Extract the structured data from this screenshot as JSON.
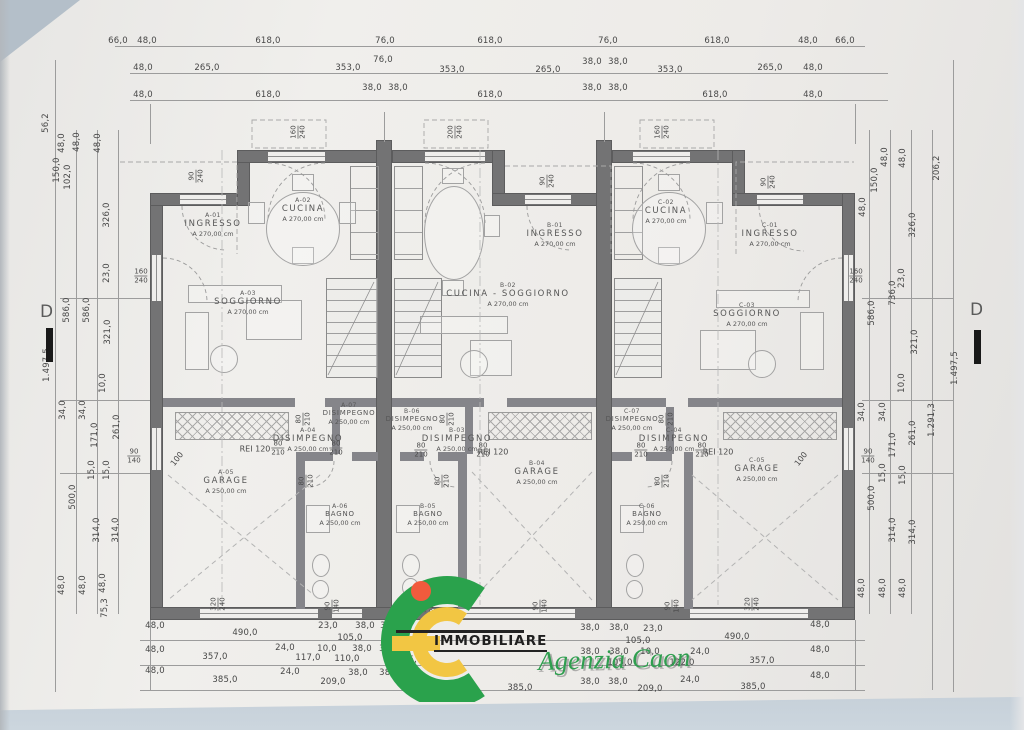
{
  "logo": {
    "brand": "IMMOBILIARE",
    "agency": "Agenzia Caon",
    "green": "#2aa24c",
    "yellow": "#f2c643",
    "red": "#f15b3d"
  },
  "section_markers": {
    "left": "D",
    "right": "D"
  },
  "dims_top": [
    {
      "t": "66,0",
      "x": 118,
      "y": 41
    },
    {
      "t": "48,0",
      "x": 147,
      "y": 41
    },
    {
      "t": "618,0",
      "x": 268,
      "y": 41
    },
    {
      "t": "76,0",
      "x": 385,
      "y": 41
    },
    {
      "t": "618,0",
      "x": 490,
      "y": 41
    },
    {
      "t": "76,0",
      "x": 608,
      "y": 41
    },
    {
      "t": "618,0",
      "x": 717,
      "y": 41
    },
    {
      "t": "48,0",
      "x": 808,
      "y": 41
    },
    {
      "t": "66,0",
      "x": 845,
      "y": 41
    },
    {
      "t": "48,0",
      "x": 143,
      "y": 68
    },
    {
      "t": "265,0",
      "x": 207,
      "y": 68
    },
    {
      "t": "353,0",
      "x": 348,
      "y": 68
    },
    {
      "t": "76,0",
      "x": 383,
      "y": 60
    },
    {
      "t": "353,0",
      "x": 452,
      "y": 70
    },
    {
      "t": "265,0",
      "x": 548,
      "y": 70
    },
    {
      "t": "38,0",
      "x": 592,
      "y": 62
    },
    {
      "t": "38,0",
      "x": 618,
      "y": 62
    },
    {
      "t": "353,0",
      "x": 670,
      "y": 70
    },
    {
      "t": "265,0",
      "x": 770,
      "y": 68
    },
    {
      "t": "48,0",
      "x": 813,
      "y": 68
    },
    {
      "t": "48,0",
      "x": 143,
      "y": 95
    },
    {
      "t": "618,0",
      "x": 268,
      "y": 95
    },
    {
      "t": "38,0",
      "x": 372,
      "y": 88
    },
    {
      "t": "38,0",
      "x": 398,
      "y": 88
    },
    {
      "t": "618,0",
      "x": 490,
      "y": 95
    },
    {
      "t": "38,0",
      "x": 592,
      "y": 88
    },
    {
      "t": "38,0",
      "x": 618,
      "y": 88
    },
    {
      "t": "618,0",
      "x": 715,
      "y": 95
    },
    {
      "t": "48,0",
      "x": 813,
      "y": 95
    }
  ],
  "dims_bottom": [
    {
      "t": "48,0",
      "x": 155,
      "y": 626
    },
    {
      "t": "490,0",
      "x": 245,
      "y": 633
    },
    {
      "t": "23,0",
      "x": 328,
      "y": 626
    },
    {
      "t": "105,0",
      "x": 350,
      "y": 638
    },
    {
      "t": "38,0",
      "x": 365,
      "y": 626
    },
    {
      "t": "38,0",
      "x": 390,
      "y": 626
    },
    {
      "t": "38,0",
      "x": 590,
      "y": 628
    },
    {
      "t": "38,0",
      "x": 619,
      "y": 628
    },
    {
      "t": "23,0",
      "x": 653,
      "y": 629
    },
    {
      "t": "105,0",
      "x": 638,
      "y": 641
    },
    {
      "t": "490,0",
      "x": 737,
      "y": 637
    },
    {
      "t": "48,0",
      "x": 820,
      "y": 625
    },
    {
      "t": "48,0",
      "x": 155,
      "y": 650
    },
    {
      "t": "357,0",
      "x": 215,
      "y": 657
    },
    {
      "t": "24,0",
      "x": 285,
      "y": 648
    },
    {
      "t": "117,0",
      "x": 308,
      "y": 658
    },
    {
      "t": "10,0",
      "x": 327,
      "y": 649
    },
    {
      "t": "110,0",
      "x": 347,
      "y": 659
    },
    {
      "t": "38,0",
      "x": 362,
      "y": 649
    },
    {
      "t": "38,0",
      "x": 389,
      "y": 649
    },
    {
      "t": "105,0",
      "x": 410,
      "y": 660
    },
    {
      "t": "38,0",
      "x": 590,
      "y": 652
    },
    {
      "t": "38,0",
      "x": 619,
      "y": 652
    },
    {
      "t": "10,0",
      "x": 650,
      "y": 652
    },
    {
      "t": "105,0",
      "x": 620,
      "y": 663
    },
    {
      "t": "122,0",
      "x": 682,
      "y": 663
    },
    {
      "t": "24,0",
      "x": 700,
      "y": 652
    },
    {
      "t": "357,0",
      "x": 762,
      "y": 661
    },
    {
      "t": "48,0",
      "x": 820,
      "y": 650
    },
    {
      "t": "48,0",
      "x": 155,
      "y": 671
    },
    {
      "t": "385,0",
      "x": 225,
      "y": 680
    },
    {
      "t": "24,0",
      "x": 290,
      "y": 672
    },
    {
      "t": "209,0",
      "x": 333,
      "y": 682
    },
    {
      "t": "38,0",
      "x": 358,
      "y": 673
    },
    {
      "t": "38,0",
      "x": 389,
      "y": 673
    },
    {
      "t": "385,0",
      "x": 520,
      "y": 688
    },
    {
      "t": "38,0",
      "x": 590,
      "y": 682
    },
    {
      "t": "38,0",
      "x": 618,
      "y": 682
    },
    {
      "t": "209,0",
      "x": 650,
      "y": 689
    },
    {
      "t": "24,0",
      "x": 690,
      "y": 680
    },
    {
      "t": "385,0",
      "x": 753,
      "y": 687
    },
    {
      "t": "48,0",
      "x": 820,
      "y": 676
    }
  ],
  "dims_left": [
    {
      "t": "56,2",
      "x": 46,
      "y": 123,
      "rot": 1
    },
    {
      "t": "48,0",
      "x": 62,
      "y": 143,
      "rot": 1
    },
    {
      "t": "150,0",
      "x": 57,
      "y": 170,
      "rot": 1
    },
    {
      "t": "102,0",
      "x": 68,
      "y": 177,
      "rot": 1
    },
    {
      "t": "48,0",
      "x": 77,
      "y": 142,
      "rot": 1
    },
    {
      "t": "48,0",
      "x": 98,
      "y": 143,
      "rot": 1
    },
    {
      "t": "326,0",
      "x": 107,
      "y": 215,
      "rot": 1
    },
    {
      "t": "23,0",
      "x": 107,
      "y": 273,
      "rot": 1
    },
    {
      "t": "586,0",
      "x": 67,
      "y": 310,
      "rot": 1
    },
    {
      "t": "586,0",
      "x": 87,
      "y": 310,
      "rot": 1
    },
    {
      "t": "321,0",
      "x": 108,
      "y": 332,
      "rot": 1
    },
    {
      "t": "1.497,5",
      "x": 47,
      "y": 365,
      "rot": 1
    },
    {
      "t": "10,0",
      "x": 103,
      "y": 383,
      "rot": 1
    },
    {
      "t": "34,0",
      "x": 63,
      "y": 410,
      "rot": 1
    },
    {
      "t": "34,0",
      "x": 83,
      "y": 410,
      "rot": 1
    },
    {
      "t": "171,0",
      "x": 95,
      "y": 435,
      "rot": 1
    },
    {
      "t": "261,0",
      "x": 117,
      "y": 427,
      "rot": 1
    },
    {
      "t": "15,0",
      "x": 92,
      "y": 470,
      "rot": 1
    },
    {
      "t": "15,0",
      "x": 107,
      "y": 470,
      "rot": 1
    },
    {
      "t": "500,0",
      "x": 73,
      "y": 497,
      "rot": 1
    },
    {
      "t": "314,0",
      "x": 97,
      "y": 530,
      "rot": 1
    },
    {
      "t": "314,0",
      "x": 116,
      "y": 530,
      "rot": 1
    },
    {
      "t": "48,0",
      "x": 62,
      "y": 585,
      "rot": 1
    },
    {
      "t": "48,0",
      "x": 83,
      "y": 585,
      "rot": 1
    },
    {
      "t": "48,0",
      "x": 103,
      "y": 583,
      "rot": 1
    },
    {
      "t": "75,3",
      "x": 105,
      "y": 608,
      "rot": 1
    }
  ],
  "dims_right": [
    {
      "t": "206,2",
      "x": 937,
      "y": 168,
      "rot": 1
    },
    {
      "t": "150,0",
      "x": 875,
      "y": 180,
      "rot": 1
    },
    {
      "t": "48,0",
      "x": 885,
      "y": 157,
      "rot": 1
    },
    {
      "t": "48,0",
      "x": 903,
      "y": 158,
      "rot": 1
    },
    {
      "t": "48,0",
      "x": 863,
      "y": 207,
      "rot": 1
    },
    {
      "t": "326,0",
      "x": 913,
      "y": 225,
      "rot": 1
    },
    {
      "t": "736,0",
      "x": 893,
      "y": 293,
      "rot": 1
    },
    {
      "t": "23,0",
      "x": 902,
      "y": 278,
      "rot": 1
    },
    {
      "t": "586,0",
      "x": 872,
      "y": 313,
      "rot": 1
    },
    {
      "t": "321,0",
      "x": 915,
      "y": 342,
      "rot": 1
    },
    {
      "t": "1.497,5",
      "x": 955,
      "y": 368,
      "rot": 1
    },
    {
      "t": "10,0",
      "x": 902,
      "y": 383,
      "rot": 1
    },
    {
      "t": "1.291,3",
      "x": 932,
      "y": 420,
      "rot": 1
    },
    {
      "t": "34,0",
      "x": 862,
      "y": 412,
      "rot": 1
    },
    {
      "t": "34,0",
      "x": 883,
      "y": 412,
      "rot": 1
    },
    {
      "t": "171,0",
      "x": 893,
      "y": 445,
      "rot": 1
    },
    {
      "t": "261,0",
      "x": 913,
      "y": 433,
      "rot": 1
    },
    {
      "t": "15,0",
      "x": 883,
      "y": 473,
      "rot": 1
    },
    {
      "t": "15,0",
      "x": 903,
      "y": 475,
      "rot": 1
    },
    {
      "t": "500,0",
      "x": 872,
      "y": 498,
      "rot": 1
    },
    {
      "t": "314,0",
      "x": 893,
      "y": 530,
      "rot": 1
    },
    {
      "t": "314,0",
      "x": 913,
      "y": 532,
      "rot": 1
    },
    {
      "t": "48,0",
      "x": 862,
      "y": 588,
      "rot": 1
    },
    {
      "t": "48,0",
      "x": 883,
      "y": 588,
      "rot": 1
    },
    {
      "t": "48,0",
      "x": 903,
      "y": 588,
      "rot": 1
    }
  ],
  "rooms": [
    {
      "c": "A-01",
      "n": "INGRESSO",
      "a": "A 270,00 cm",
      "x": 213,
      "y": 225
    },
    {
      "c": "A-02",
      "n": "CUCINA",
      "a": "A 270,00 cm",
      "x": 303,
      "y": 210
    },
    {
      "c": "A-03",
      "n": "SOGGIORNO",
      "a": "A 270,00 cm",
      "x": 248,
      "y": 303
    },
    {
      "c": "A-07",
      "n": "DISIMPEGNO",
      "a": "A 250,00 cm",
      "x": 349,
      "y": 414,
      "s": 1
    },
    {
      "c": "A-04",
      "n": "DISIMPEGNO",
      "a": "A 250,00 cm",
      "x": 308,
      "y": 440
    },
    {
      "c": "A-05",
      "n": "GARAGE",
      "a": "A 250,00 cm",
      "x": 226,
      "y": 482
    },
    {
      "c": "A-06",
      "n": "BAGNO",
      "a": "A 250,00 cm",
      "x": 340,
      "y": 515,
      "s": 1
    },
    {
      "c": "B-01",
      "n": "INGRESSO",
      "a": "A 270,00 cm",
      "x": 555,
      "y": 235
    },
    {
      "c": "B-02",
      "n": "CUCINA - SOGGIORNO",
      "a": "A 270,00 cm",
      "x": 508,
      "y": 295
    },
    {
      "c": "B-06",
      "n": "DISIMPEGNO",
      "a": "A 250,00 cm",
      "x": 412,
      "y": 420,
      "s": 1
    },
    {
      "c": "B-03",
      "n": "DISIMPEGNO",
      "a": "A 250,00 cm",
      "x": 457,
      "y": 440
    },
    {
      "c": "B-04",
      "n": "GARAGE",
      "a": "A 250,00 cm",
      "x": 537,
      "y": 473
    },
    {
      "c": "B-05",
      "n": "BAGNO",
      "a": "A 250,00 cm",
      "x": 428,
      "y": 515,
      "s": 1
    },
    {
      "c": "C-02",
      "n": "CUCINA",
      "a": "A 270,00 cm",
      "x": 666,
      "y": 212
    },
    {
      "c": "C-01",
      "n": "INGRESSO",
      "a": "A 270,00 cm",
      "x": 770,
      "y": 235
    },
    {
      "c": "C-03",
      "n": "SOGGIORNO",
      "a": "A 270,00 cm",
      "x": 747,
      "y": 315
    },
    {
      "c": "C-07",
      "n": "DISIMPEGNO",
      "a": "A 250,00 cm",
      "x": 632,
      "y": 420,
      "s": 1
    },
    {
      "c": "C-04",
      "n": "DISIMPEGNO",
      "a": "A 250,00 cm",
      "x": 674,
      "y": 440
    },
    {
      "c": "C-05",
      "n": "GARAGE",
      "a": "A 250,00 cm",
      "x": 757,
      "y": 470
    },
    {
      "c": "C-06",
      "n": "BAGNO",
      "a": "A 250,00 cm",
      "x": 647,
      "y": 515,
      "s": 1
    }
  ],
  "fire_labels": [
    {
      "t": "REI 120",
      "x": 255,
      "y": 449
    },
    {
      "t": "REI 120",
      "x": 493,
      "y": 452
    },
    {
      "t": "REI 120",
      "x": 718,
      "y": 452
    },
    {
      "t": "100",
      "x": 177,
      "y": 459,
      "rot": 1
    },
    {
      "t": "100",
      "x": 801,
      "y": 459,
      "rot": 1
    }
  ],
  "pairs": [
    {
      "a": "160",
      "b": "240",
      "x": 298,
      "y": 132,
      "rot": 1
    },
    {
      "a": "200",
      "b": "240",
      "x": 455,
      "y": 132,
      "rot": 1
    },
    {
      "a": "160",
      "b": "240",
      "x": 662,
      "y": 132,
      "rot": 1
    },
    {
      "a": "90",
      "b": "240",
      "x": 196,
      "y": 176,
      "rot": 1
    },
    {
      "a": "90",
      "b": "240",
      "x": 547,
      "y": 181,
      "rot": 1
    },
    {
      "a": "90",
      "b": "240",
      "x": 768,
      "y": 182,
      "rot": 1
    },
    {
      "a": "160",
      "b": "240",
      "x": 141,
      "y": 276
    },
    {
      "a": "160",
      "b": "240",
      "x": 856,
      "y": 276
    },
    {
      "a": "90",
      "b": "140",
      "x": 134,
      "y": 456
    },
    {
      "a": "90",
      "b": "140",
      "x": 868,
      "y": 456
    },
    {
      "a": "80",
      "b": "210",
      "x": 278,
      "y": 448
    },
    {
      "a": "80",
      "b": "210",
      "x": 336,
      "y": 448
    },
    {
      "a": "80",
      "b": "210",
      "x": 306,
      "y": 481,
      "rot": 1
    },
    {
      "a": "80",
      "b": "210",
      "x": 303,
      "y": 419,
      "rot": 1
    },
    {
      "a": "80",
      "b": "210",
      "x": 421,
      "y": 450
    },
    {
      "a": "80",
      "b": "210",
      "x": 483,
      "y": 450
    },
    {
      "a": "80",
      "b": "210",
      "x": 442,
      "y": 481,
      "rot": 1
    },
    {
      "a": "80",
      "b": "210",
      "x": 447,
      "y": 419,
      "rot": 1
    },
    {
      "a": "80",
      "b": "210",
      "x": 641,
      "y": 450
    },
    {
      "a": "80",
      "b": "210",
      "x": 702,
      "y": 450
    },
    {
      "a": "80",
      "b": "210",
      "x": 662,
      "y": 481,
      "rot": 1
    },
    {
      "a": "80",
      "b": "210",
      "x": 666,
      "y": 419,
      "rot": 1
    },
    {
      "a": "320",
      "b": "240",
      "x": 218,
      "y": 604,
      "rot": 1
    },
    {
      "a": "90",
      "b": "140",
      "x": 332,
      "y": 606,
      "rot": 1
    },
    {
      "a": "320",
      "b": "240",
      "x": 428,
      "y": 606,
      "rot": 1
    },
    {
      "a": "90",
      "b": "140",
      "x": 540,
      "y": 606,
      "rot": 1
    },
    {
      "a": "90",
      "b": "140",
      "x": 672,
      "y": 606,
      "rot": 1
    },
    {
      "a": "320",
      "b": "240",
      "x": 752,
      "y": 604,
      "rot": 1
    }
  ]
}
